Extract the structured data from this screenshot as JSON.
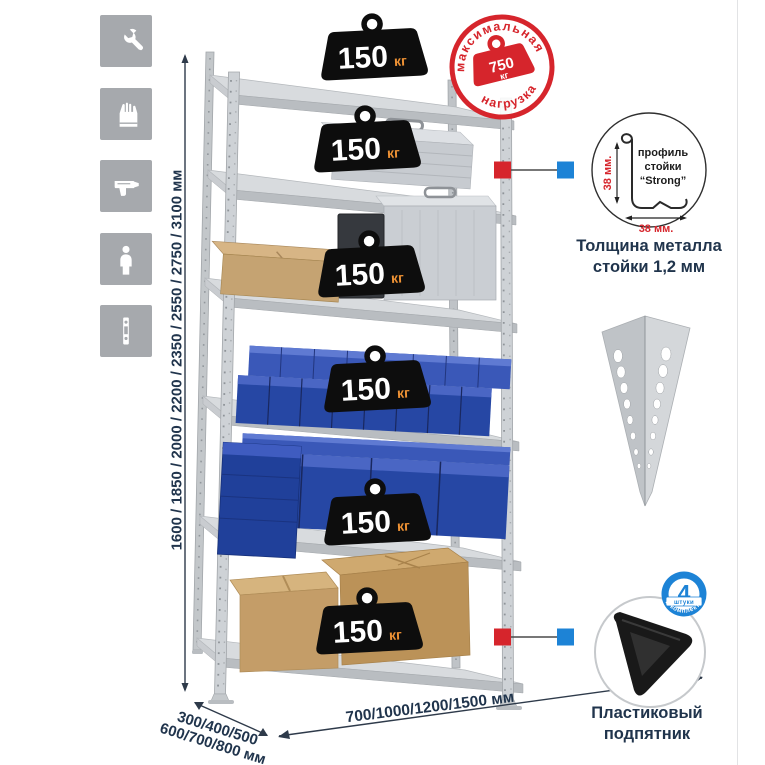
{
  "palette": {
    "accent_red": "#d6252c",
    "accent_blue": "#1d83d6",
    "dark_text": "#20344c",
    "tile_gray": "#a6a9ad",
    "weight_unit_orange": "#ef9234",
    "bin_blue": "#2647a4",
    "metal_gray": "#c9cdd2"
  },
  "left_icons": {
    "items": [
      {
        "name": "wrench-icon"
      },
      {
        "name": "gloves-icon"
      },
      {
        "name": "drill-icon"
      },
      {
        "name": "person-icon"
      },
      {
        "name": "perforated-profile-icon"
      }
    ]
  },
  "height_dimension": {
    "label": "1600 / 1850 / 2000 / 2200 / 2350 / 2550 / 2750 / 3100 мм"
  },
  "depth_dimension": {
    "line1": "300/400/500",
    "line2": "600/700/800 мм"
  },
  "width_dimension": {
    "label": "700/1000/1200/1500 мм"
  },
  "rack": {
    "shelf_count": 6,
    "weights": [
      {
        "value": "150",
        "unit": "кг"
      },
      {
        "value": "150",
        "unit": "кг"
      },
      {
        "value": "150",
        "unit": "кг"
      },
      {
        "value": "150",
        "unit": "кг"
      },
      {
        "value": "150",
        "unit": "кг"
      },
      {
        "value": "150",
        "unit": "кг"
      }
    ]
  },
  "max_load_stamp": {
    "arc_top": "максимальная",
    "arc_bottom": "нагрузка",
    "value": "750",
    "unit": "кг"
  },
  "profile_detail": {
    "label_line1": "профиль",
    "label_line2": "стойки",
    "label_line3": "“Strong”",
    "dim_vertical": "38 мм.",
    "dim_horizontal": "38 мм.",
    "caption_line1": "Толщина металла",
    "caption_line2": "стойки 1,2 мм"
  },
  "foot_detail": {
    "badge_value": "4",
    "badge_ribbon": "штуки",
    "badge_arc": "в комплекте",
    "caption_line1": "Пластиковый",
    "caption_line2": "подпятник"
  }
}
